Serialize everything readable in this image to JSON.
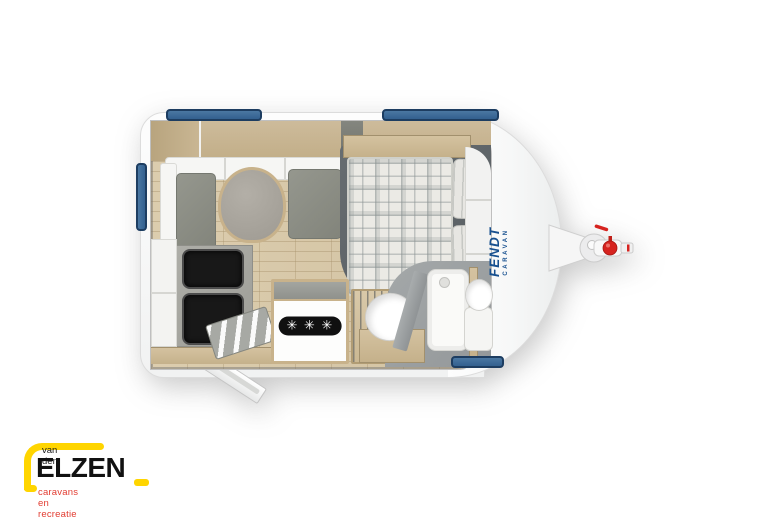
{
  "caravan": {
    "brand": {
      "name": "FENDT",
      "sub": "CARAVAN",
      "color": "#17508f"
    },
    "fridge_rating": "✳ ✳ ✳",
    "accent_colors": {
      "window_blue": "#3e6da4",
      "hitch_red": "#d6231f",
      "body_white": "#ffffff",
      "wood": "#cdbb9b"
    }
  },
  "dealer_logo": {
    "line1": "van den",
    "line2": "ELZEN",
    "line3": "caravans en recreatie",
    "colors": {
      "yellow": "#ffd500",
      "red": "#e23c31",
      "black": "#111111"
    }
  }
}
